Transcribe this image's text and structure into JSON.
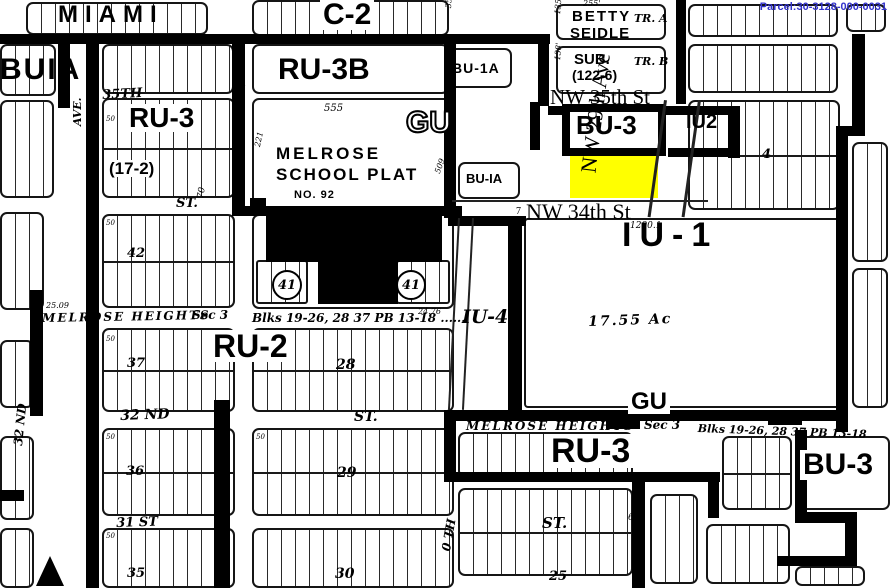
{
  "map": {
    "parcel_id": "Parcel:30-3128-000-0031",
    "parcel_id_color": "#3333cc",
    "highlight_color": "#ffff00"
  },
  "circles": [
    {
      "name": "lot-41-circle-west",
      "text": "41",
      "x": 272,
      "y": 270
    },
    {
      "name": "lot-41-circle-east",
      "text": "41",
      "x": 396,
      "y": 270
    }
  ],
  "labels": [
    {
      "name": "zone-label-c2",
      "text": "C-2",
      "x": 320,
      "y": 0,
      "fs": 30,
      "cls": "zb"
    },
    {
      "name": "zone-label-ru3b",
      "text": "RU-3B",
      "x": 278,
      "y": 55,
      "fs": 30,
      "cls": "zn"
    },
    {
      "name": "zone-label-bu1a-top",
      "text": "BU-1A",
      "x": 452,
      "y": 61,
      "fs": 14,
      "cls": "zn",
      "ls": 1
    },
    {
      "name": "zone-label-ru3-west",
      "text": "RU-3",
      "x": 126,
      "y": 104,
      "fs": 28,
      "cls": "zb"
    },
    {
      "name": "plat-ref-17-2",
      "text": "(17-2)",
      "x": 106,
      "y": 160,
      "fs": 17,
      "cls": "zb"
    },
    {
      "name": "zone-label-gu-hollow",
      "text": "GU",
      "x": 406,
      "y": 108,
      "fs": 30,
      "cls": "hollow"
    },
    {
      "name": "zone-label-bu3-top",
      "text": "BU-3",
      "x": 576,
      "y": 112,
      "fs": 26,
      "cls": "zn"
    },
    {
      "name": "zone-label-iu2",
      "text": "IU2",
      "x": 686,
      "y": 112,
      "fs": 20,
      "cls": "zn"
    },
    {
      "name": "zone-label-iu1",
      "text": "IU-1",
      "x": 622,
      "y": 218,
      "fs": 34,
      "cls": "zn",
      "ls": 8
    },
    {
      "name": "zone-label-iu4",
      "text": "IU-4",
      "x": 462,
      "y": 308,
      "fs": 19,
      "cls": "hand"
    },
    {
      "name": "zone-label-ru2",
      "text": "RU-2",
      "x": 210,
      "y": 330,
      "fs": 32,
      "cls": "zb"
    },
    {
      "name": "zone-label-ru3-south",
      "text": "RU-3",
      "x": 548,
      "y": 434,
      "fs": 34,
      "cls": "zb"
    },
    {
      "name": "zone-label-bu3-south",
      "text": "BU-3",
      "x": 800,
      "y": 450,
      "fs": 30,
      "cls": "zb"
    },
    {
      "name": "zone-label-gu-south",
      "text": "GU",
      "x": 628,
      "y": 390,
      "fs": 24,
      "cls": "zb"
    },
    {
      "name": "zone-label-bu1a-west-edge",
      "text": "BUIA",
      "x": 0,
      "y": 55,
      "fs": 30,
      "cls": "zn",
      "ls": 2
    },
    {
      "name": "area-label-miami",
      "text": "MIAMI",
      "x": 58,
      "y": 3,
      "fs": 24,
      "cls": "zn",
      "ls": 7
    },
    {
      "name": "plat-label-betty",
      "text": "BETTY",
      "x": 572,
      "y": 9,
      "fs": 15,
      "cls": "zn",
      "ls": 2
    },
    {
      "name": "plat-label-seidle",
      "text": "SEIDLE",
      "x": 570,
      "y": 26,
      "fs": 15,
      "cls": "zn",
      "ls": 1
    },
    {
      "name": "tract-label-a",
      "text": "TR. A",
      "x": 634,
      "y": 13,
      "fs": 11,
      "cls": "hand"
    },
    {
      "name": "plat-label-sub",
      "text": "SUB.",
      "x": 574,
      "y": 52,
      "fs": 15,
      "cls": "zn"
    },
    {
      "name": "plat-ref-122-6",
      "text": "(122-6)",
      "x": 572,
      "y": 68,
      "fs": 14,
      "cls": "zn"
    },
    {
      "name": "tract-label-b",
      "text": "TR. B",
      "x": 634,
      "y": 56,
      "fs": 11,
      "cls": "hand"
    },
    {
      "name": "plat-label-melrose",
      "text": "MELROSE",
      "x": 276,
      "y": 145,
      "fs": 17,
      "cls": "zn",
      "ls": 3
    },
    {
      "name": "plat-label-school-plat",
      "text": "SCHOOL  PLAT",
      "x": 276,
      "y": 166,
      "fs": 17,
      "cls": "zn",
      "ls": 2
    },
    {
      "name": "plat-label-no-92",
      "text": "NO. 92",
      "x": 294,
      "y": 190,
      "fs": 11,
      "cls": "zn",
      "ls": 1
    },
    {
      "name": "zone-label-bu1a-mid",
      "text": "BU-IA",
      "x": 466,
      "y": 172,
      "fs": 13,
      "cls": "zn"
    },
    {
      "name": "street-label-nw-35th-st",
      "text": "NW 35th St",
      "x": 550,
      "y": 87,
      "fs": 21,
      "cls": "serif"
    },
    {
      "name": "street-label-nw-34th-st",
      "text": "NW 34th St",
      "x": 526,
      "y": 201,
      "fs": 22,
      "cls": "serif"
    },
    {
      "name": "street-label-nw-34th-prefix",
      "text": "7",
      "x": 516,
      "y": 207,
      "fs": 10,
      "cls": "serif"
    },
    {
      "name": "street-label-nw-29th-ave",
      "text": "NW 29th Ave",
      "x": 572,
      "y": 216,
      "fs": 22,
      "cls": "serif",
      "rot": -83,
      "w": 210,
      "ta": "center"
    },
    {
      "name": "street-label-35th-nw",
      "text": "35TH",
      "x": 102,
      "y": 89,
      "fs": 13,
      "cls": "hand",
      "rot": -3
    },
    {
      "name": "street-label-ave-w",
      "text": "AVE.",
      "x": 72,
      "y": 126,
      "fs": 11,
      "cls": "hand",
      "rot": -90
    },
    {
      "name": "street-label-ave-mid",
      "text": "AVE.",
      "x": 234,
      "y": 114,
      "fs": 12,
      "cls": "hand",
      "rot": -88
    },
    {
      "name": "street-label-ave-e",
      "text": "AVE.",
      "x": 444,
      "y": 114,
      "fs": 12,
      "cls": "hand",
      "rot": -88
    },
    {
      "name": "street-label-st-nw",
      "text": "ST.",
      "x": 176,
      "y": 197,
      "fs": 13,
      "cls": "hand"
    },
    {
      "name": "meas-70",
      "text": "70",
      "x": 197,
      "y": 198,
      "fs": 9,
      "cls": "tiny",
      "rot": -80
    },
    {
      "name": "plat-label-melrose-heights-n",
      "text": "MELROSE HEIGHTS",
      "x": 42,
      "y": 312,
      "fs": 12,
      "cls": "hand",
      "ls": 2,
      "rot": -1
    },
    {
      "name": "plat-label-sec3-n",
      "text": "Sec 3",
      "x": 192,
      "y": 309,
      "fs": 12,
      "cls": "hand"
    },
    {
      "name": "plat-label-blks-n",
      "text": "Blks 19-26, 28 37 PB 13-18 ......",
      "x": 252,
      "y": 312,
      "fs": 12,
      "cls": "hand"
    },
    {
      "name": "plat-label-melrose-heights-s",
      "text": "MELROSE HEIGHTS",
      "x": 466,
      "y": 420,
      "fs": 12,
      "cls": "hand",
      "ls": 2
    },
    {
      "name": "plat-label-sec3-s",
      "text": "Sec 3",
      "x": 644,
      "y": 419,
      "fs": 12,
      "cls": "hand"
    },
    {
      "name": "plat-label-blks-s",
      "text": "Blks 19-26, 28 37 PB 13-18",
      "x": 698,
      "y": 423,
      "fs": 11,
      "cls": "hand",
      "rot": 2
    },
    {
      "name": "street-label-32nd",
      "text": "32 ND",
      "x": 120,
      "y": 409,
      "fs": 14,
      "cls": "hand",
      "rot": -2
    },
    {
      "name": "street-label-st-mid",
      "text": "ST.",
      "x": 354,
      "y": 410,
      "fs": 14,
      "cls": "hand"
    },
    {
      "name": "street-label-31st",
      "text": "31 ST",
      "x": 116,
      "y": 517,
      "fs": 13,
      "cls": "hand",
      "rot": -2
    },
    {
      "name": "street-label-st-s",
      "text": "ST.",
      "x": 542,
      "y": 516,
      "fs": 15,
      "cls": "hand"
    },
    {
      "name": "street-label-32nd-vert",
      "text": "32 ND",
      "x": 12,
      "y": 445,
      "fs": 12,
      "cls": "hand",
      "rot": -84
    },
    {
      "name": "street-label-0th-vert",
      "text": "0 TH",
      "x": 440,
      "y": 550,
      "fs": 12,
      "cls": "hand",
      "rot": -80
    },
    {
      "name": "block-num-42",
      "text": "42",
      "x": 127,
      "y": 247,
      "fs": 13,
      "cls": "hand"
    },
    {
      "name": "block-num-37",
      "text": "37",
      "x": 127,
      "y": 357,
      "fs": 13,
      "cls": "hand"
    },
    {
      "name": "block-num-36",
      "text": "36",
      "x": 126,
      "y": 465,
      "fs": 13,
      "cls": "hand"
    },
    {
      "name": "block-num-35",
      "text": "35",
      "x": 127,
      "y": 567,
      "fs": 13,
      "cls": "hand"
    },
    {
      "name": "block-num-28",
      "text": "28",
      "x": 336,
      "y": 358,
      "fs": 14,
      "cls": "hand"
    },
    {
      "name": "block-num-29",
      "text": "29",
      "x": 337,
      "y": 466,
      "fs": 14,
      "cls": "hand"
    },
    {
      "name": "block-num-30",
      "text": "30",
      "x": 335,
      "y": 567,
      "fs": 14,
      "cls": "hand"
    },
    {
      "name": "block-num-25",
      "text": "25",
      "x": 549,
      "y": 570,
      "fs": 13,
      "cls": "hand"
    },
    {
      "name": "block-num-4",
      "text": "4",
      "x": 762,
      "y": 148,
      "fs": 13,
      "cls": "hand"
    },
    {
      "name": "area-label-1755-ac",
      "text": "17.55 Ac",
      "x": 588,
      "y": 315,
      "fs": 14,
      "cls": "hand",
      "ls": 2,
      "rot": -2
    },
    {
      "name": "meas-1290-1",
      "text": "1290.1",
      "x": 630,
      "y": 222,
      "fs": 9,
      "cls": "tiny"
    },
    {
      "name": "meas-3524",
      "text": "3524",
      "x": 445,
      "y": 8,
      "fs": 8,
      "cls": "tiny",
      "rot": -87
    },
    {
      "name": "meas-255",
      "text": "255'",
      "x": 583,
      "y": 0,
      "fs": 8,
      "cls": "tiny"
    },
    {
      "name": "meas-135",
      "text": "135'",
      "x": 554,
      "y": 14,
      "fs": 8,
      "cls": "tiny",
      "rot": -85
    },
    {
      "name": "meas-138",
      "text": "138'",
      "x": 554,
      "y": 60,
      "fs": 8,
      "cls": "tiny",
      "rot": -85
    },
    {
      "name": "meas-555",
      "text": "555",
      "x": 324,
      "y": 104,
      "fs": 10,
      "cls": "tiny"
    },
    {
      "name": "meas-221",
      "text": "221",
      "x": 254,
      "y": 146,
      "fs": 8,
      "cls": "tiny",
      "rot": -78
    },
    {
      "name": "meas-509",
      "text": "509",
      "x": 434,
      "y": 172,
      "fs": 8,
      "cls": "tiny",
      "rot": -70
    },
    {
      "name": "meas-25-09",
      "text": "25.09",
      "x": 46,
      "y": 302,
      "fs": 8,
      "cls": "tiny"
    },
    {
      "name": "meas-24-76",
      "text": "24.76",
      "x": 418,
      "y": 308,
      "fs": 8,
      "cls": "tiny"
    },
    {
      "name": "meas-60",
      "text": "60",
      "x": 628,
      "y": 514,
      "fs": 9,
      "cls": "tiny"
    },
    {
      "name": "meas-50-a",
      "text": "50",
      "x": 106,
      "y": 116,
      "fs": 7,
      "cls": "tiny"
    },
    {
      "name": "meas-50-b",
      "text": "50",
      "x": 106,
      "y": 220,
      "fs": 7,
      "cls": "tiny"
    },
    {
      "name": "meas-50-c",
      "text": "50",
      "x": 106,
      "y": 336,
      "fs": 7,
      "cls": "tiny"
    },
    {
      "name": "meas-50-d",
      "text": "50",
      "x": 106,
      "y": 434,
      "fs": 7,
      "cls": "tiny"
    },
    {
      "name": "meas-50-e",
      "text": "50",
      "x": 106,
      "y": 533,
      "fs": 7,
      "cls": "tiny"
    },
    {
      "name": "meas-50-f",
      "text": "50",
      "x": 256,
      "y": 434,
      "fs": 7,
      "cls": "tiny"
    },
    {
      "name": "meas-137-5-a",
      "text": "137.5",
      "x": 94,
      "y": 158,
      "fs": 7,
      "cls": "tiny",
      "rot": -90
    },
    {
      "name": "meas-137-5-b",
      "text": "137.5",
      "x": 94,
      "y": 378,
      "fs": 7,
      "cls": "tiny",
      "rot": -90
    }
  ]
}
